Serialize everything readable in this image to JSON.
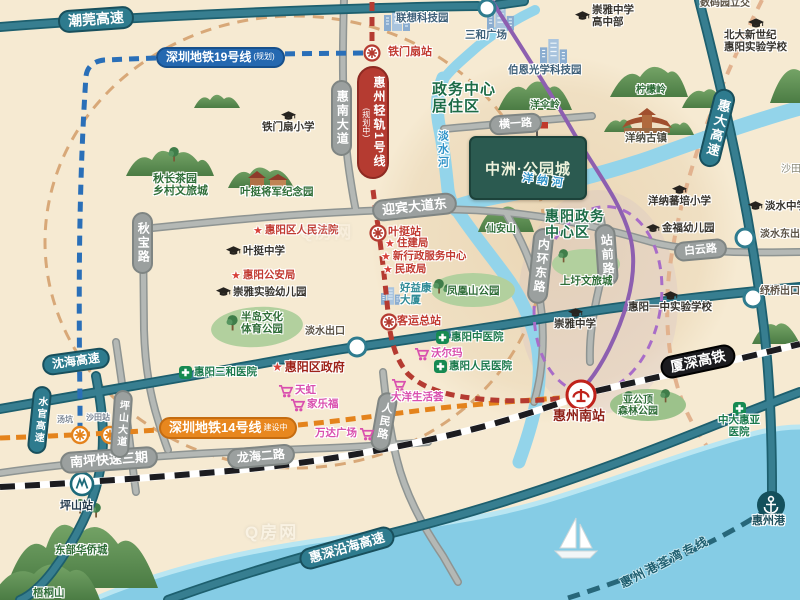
{
  "watermark": "Q房网",
  "project": {
    "name": "中洲·公园城"
  },
  "highways": {
    "chaowan": "潮莞高速",
    "shenhai": "沈海高速",
    "huida": "惠大高速",
    "huishen_coastal": "惠深沿海高速",
    "shuiguan": "水官高速"
  },
  "roads": {
    "huinan_ave": "惠南大道",
    "yingbin_ave_e": "迎宾大道东",
    "hengyi_rd": "横一路",
    "qiubao_rd": "秋宝路",
    "neihuan_e_rd": "内环东路",
    "zhanqian_rd": "站前路",
    "baiyun_rd": "白云路",
    "nanping_expwy3": "南坪快速三期",
    "longhai_2_rd": "龙海二路",
    "renmin_rd": "人民路",
    "pingshan_ave": "坪山大道"
  },
  "transit": {
    "metro19": "深圳地铁19号线",
    "metro19_tag": "(规划)",
    "metro14": "深圳地铁14号线",
    "metro14_tag": "建设中",
    "tram1": "惠州轻轨1号线",
    "tram1_tag": "(规划中)",
    "xiashen_hsr": "厦深高铁",
    "port_line": "惠州港荃湾专线"
  },
  "stations": {
    "tiemenshan": "铁门扇站",
    "yeting": "叶挺站",
    "keyun": "客运总站",
    "tangkeng": "汤坑",
    "shatian": "沙田站",
    "pingshan": "坪山站",
    "huizhou_south": "惠州南站",
    "huizhou_port": "惠州港"
  },
  "exits": {
    "danshui": "淡水出口",
    "danshui_east": "淡水东出口",
    "shuqiao": "纾桥出口",
    "shuma_interchange": "数码园立交"
  },
  "districts": {
    "gov_residence": [
      "政务中心",
      "居住区"
    ],
    "gov_center": [
      "惠阳政务",
      "中心区"
    ],
    "shatian_town": "沙田"
  },
  "schools": {
    "chongya_high": [
      "崇雅中学",
      "高中部"
    ],
    "beida_new": [
      "北大新世纪",
      "惠阳实验学校"
    ],
    "tiemenshan_primary": "铁门扇小学",
    "yeting_middle": "叶挺中学",
    "chongya_kindergarten": "崇雅实验幼儿园",
    "yangna_primary": "洋纳蕃培小学",
    "jinfu_kindergarten": "金福幼儿园",
    "huiyang_no1": "惠阳一中实验学校",
    "chongya_middle": "崇雅中学",
    "danshui_middle": "淡水中学"
  },
  "government": {
    "court": "惠阳区人民法院",
    "zhujianju": "住建局",
    "admin_center": "新行政服务中心",
    "minzhengju": "民政局",
    "police": "惠阳公安局",
    "district_gov": "惠阳区政府"
  },
  "hospitals": {
    "sanhe": "惠阳三和医院",
    "tcm": "惠阳中医院",
    "renmin": "惠阳人民医院",
    "zhongda": [
      "中大惠亚",
      "医院"
    ]
  },
  "shopping": {
    "rainbow": "天虹",
    "carrefour": "家乐福",
    "wanda": "万达广场",
    "dayang": "大洋生活荟",
    "walmart": "沃尔玛"
  },
  "landmarks": {
    "qiuchang_tea": [
      "秋长茶园",
      "乡村文旅城"
    ],
    "yeting_memorial": "叶挺将军纪念园",
    "bandao_park": [
      "半岛文化",
      "体育公园"
    ],
    "fenghuangshan_park": "凤凰山公园",
    "shangxu_town": "上圩文旅城",
    "yangna_old_town": "洋纳古镇",
    "yagongding_park": [
      "亚公顶",
      "森林公园"
    ],
    "oct_east": "东部华侨城",
    "wutongshan": "梧桐山",
    "xiananshan": "仙安山",
    "yangsanling": "洋伞岭",
    "ningmengling": "柠檬岭",
    "lenovo_park": "联想科技园",
    "sanhe_plaza": "三和广场",
    "boen_optical": "伯恩光学科技园",
    "haoyikang": [
      "好益康",
      "大厦"
    ]
  },
  "rivers": {
    "danshui_river": "淡水河",
    "yangna_river": "洋纳河"
  }
}
